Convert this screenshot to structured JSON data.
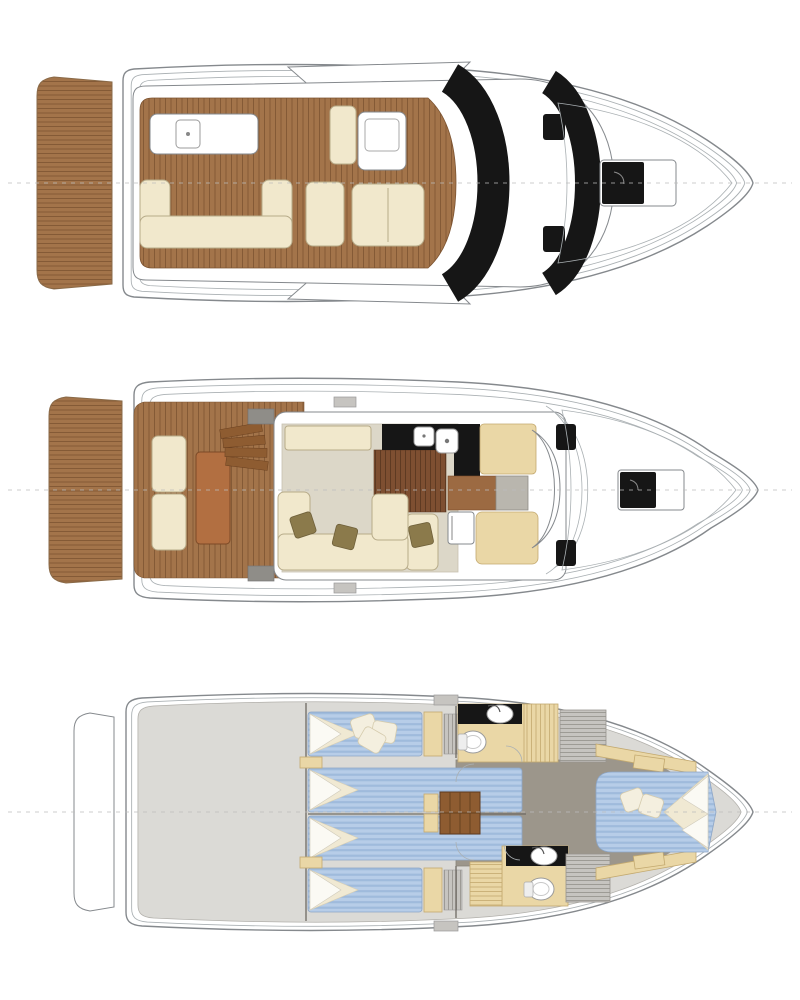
{
  "figure": {
    "type": "yacht-deck-plans",
    "orientation": "bow-right",
    "decks": [
      {
        "id": "flybridge-deck",
        "position": "top",
        "features": [
          "swim-platform",
          "flybridge-teak-floor",
          "wet-bar",
          "u-sofa",
          "lounge-seat",
          "helm-console",
          "helm-seats",
          "windshield-glazing",
          "side-windows",
          "foredeck-hatch",
          "bow-toe-rail",
          "centerline"
        ]
      },
      {
        "id": "main-deck",
        "position": "middle",
        "features": [
          "swim-platform",
          "aft-cockpit",
          "transom-bench",
          "cockpit-table",
          "cockpit-steps",
          "salon-carpet",
          "salon-sofa",
          "sideboard",
          "galley-counter",
          "galley-sinks",
          "galley-wood-floor",
          "fridge",
          "dinette-seat",
          "helm-seat",
          "dashboard",
          "windshield",
          "foredeck-hatch",
          "bow-toe-rail",
          "centerline"
        ]
      },
      {
        "id": "lower-deck",
        "position": "bottom",
        "features": [
          "swim-platform-outline",
          "engine-room",
          "twin-berths-port",
          "twin-berths-starboard",
          "wardrobes",
          "center-staircase",
          "corridor",
          "forward-head",
          "aft-head",
          "companionway-steps",
          "vip-cabin",
          "vip-island-bed",
          "centerline"
        ]
      }
    ]
  },
  "colors": {
    "hullStroke": "#85898d",
    "hullStroke2": "#aab0b3",
    "teak": "#a3744a",
    "teakLine": "#7c5330",
    "teakDark": "#b26f41",
    "cream": "#f1e8cc",
    "creamStroke": "#b7ab89",
    "tan": "#ead7a6",
    "tanStroke": "#c3a96f",
    "olive": "#8b7a4b",
    "black": "#161616",
    "carpet": "#dcd7c8",
    "galleyWood": "#7e4f31",
    "galleyLine": "#5e3a22",
    "brownFloor": "#9c6a42",
    "bedBlue": "#b7cde8",
    "bedStripe": "#9fbbdc",
    "pillowWhite": "#fbfaf4",
    "blanket": "#f0e9d3",
    "lowerFloor": "#dbdad6",
    "corridor": "#9c968b",
    "grayStep": "#c6c4c0",
    "stepLine": "#999690",
    "stairBrown": "#8e5c31",
    "stairLine": "#67421f",
    "wall": "#6e6a63",
    "seatGray": "#b9b6ae",
    "darkGray": "#8f8d88",
    "centerline": "#bcbcbc",
    "background": "#ffffff"
  }
}
